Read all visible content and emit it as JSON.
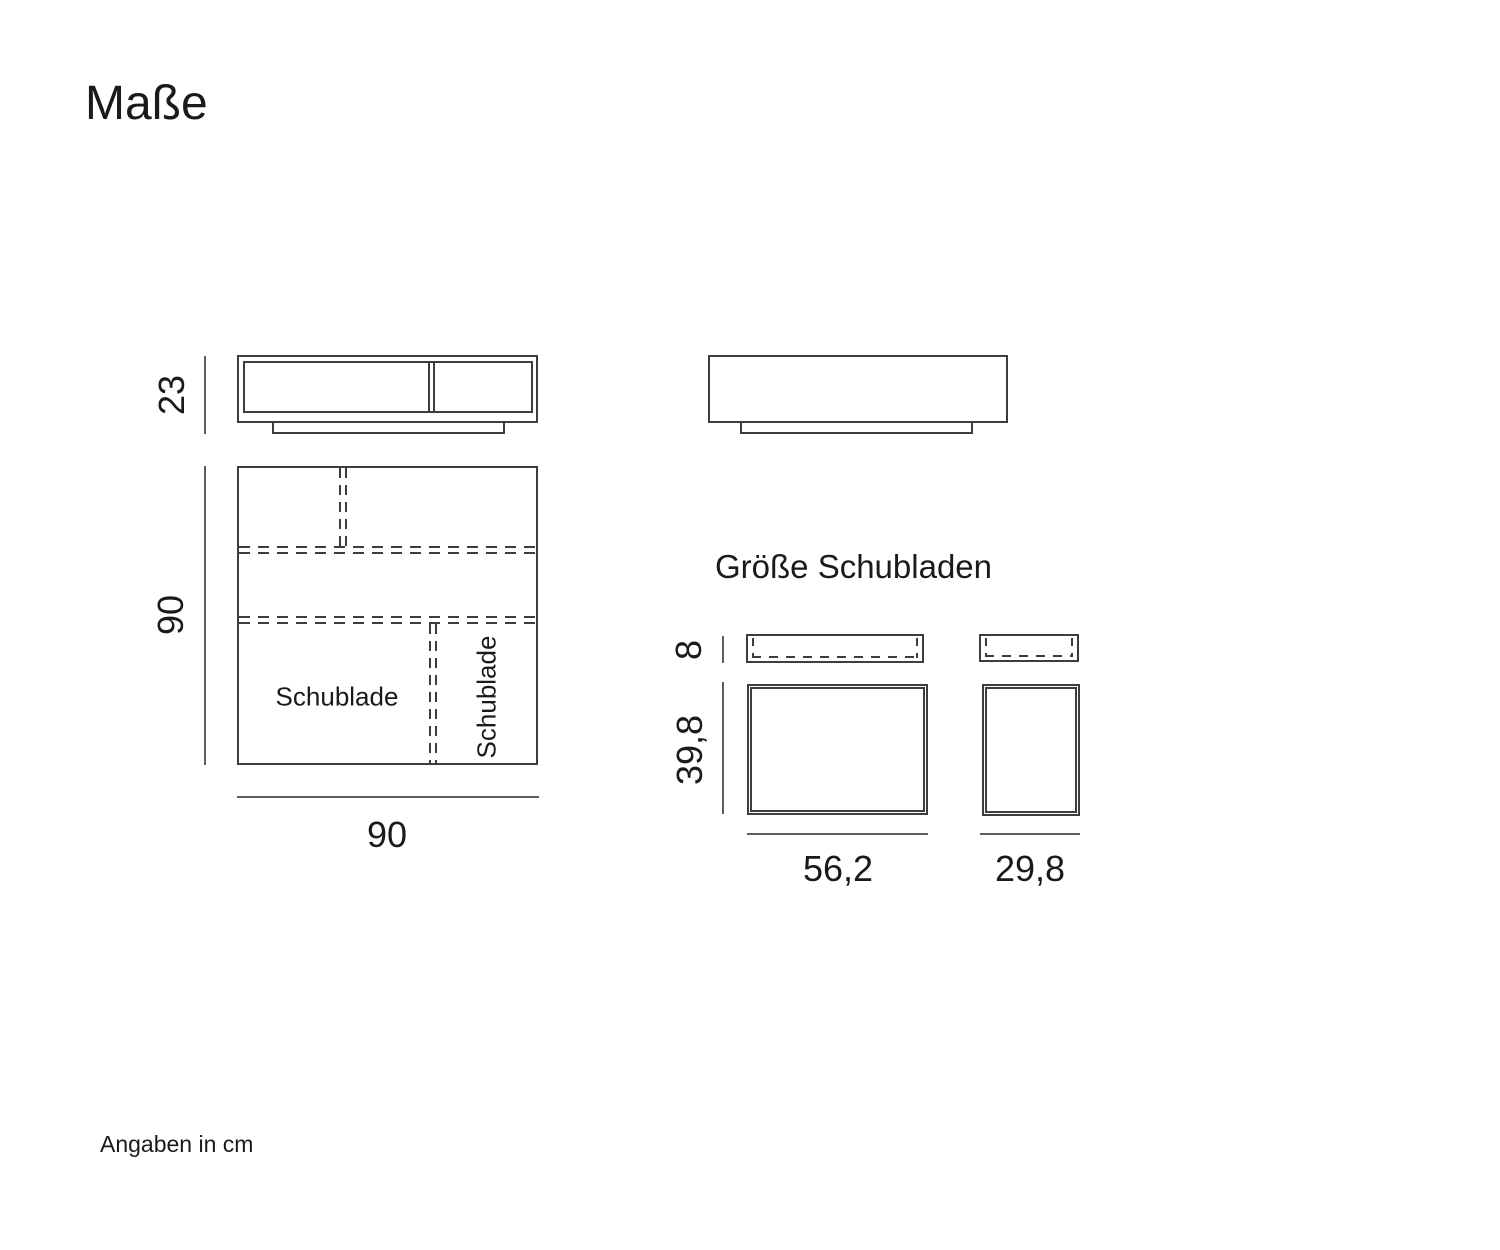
{
  "page": {
    "title": "Maße",
    "footer_note": "Angaben in cm"
  },
  "colors": {
    "line": "#3d3d3d",
    "dim_line": "#5e5e5e",
    "text": "#1a1a1a",
    "bg": "#ffffff"
  },
  "front_view": {
    "height_label": "23"
  },
  "side_view": {},
  "top_view": {
    "depth_label": "90",
    "width_label": "90",
    "drawer_label_left": "Schublade",
    "drawer_label_right": "Schublade"
  },
  "drawer_section": {
    "heading": "Größe Schubladen",
    "front_height_label": "8",
    "drawer_depth_label": "39,8",
    "wide_drawer_width_label": "56,2",
    "narrow_drawer_width_label": "29,8"
  }
}
